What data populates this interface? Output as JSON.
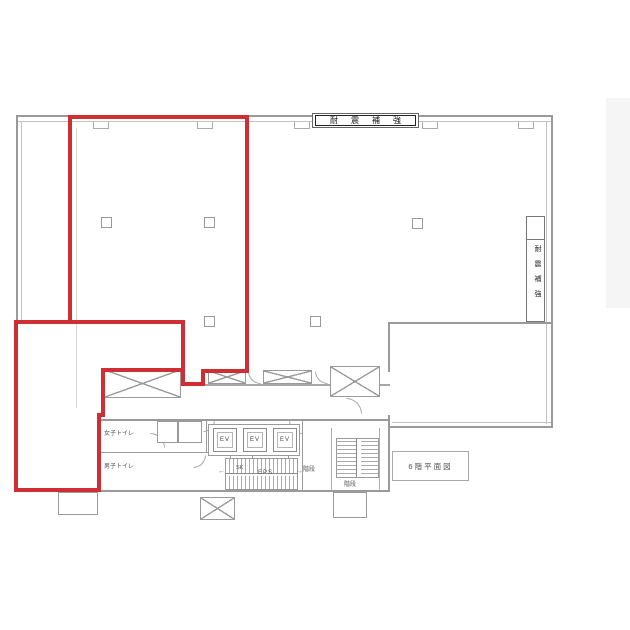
{
  "plan": {
    "floor_title": "6階平面図",
    "seismic_label_top": "耐震補強",
    "seismic_label_right": "耐震補強",
    "rooms": {
      "womens_toilet": "女子トイレ",
      "mens_toilet": "男子トイレ",
      "sk": "SK",
      "eps": "EPS",
      "elevator": "EV",
      "stairs_main": "階段",
      "stairs_sub": "階段"
    },
    "colors": {
      "highlight_red": "#cf2f33",
      "wall_gray": "#9a9a9a",
      "side_strip": "#f5f5f5"
    },
    "stair_arrow_left": "←",
    "stair_arrow_right": "→"
  }
}
